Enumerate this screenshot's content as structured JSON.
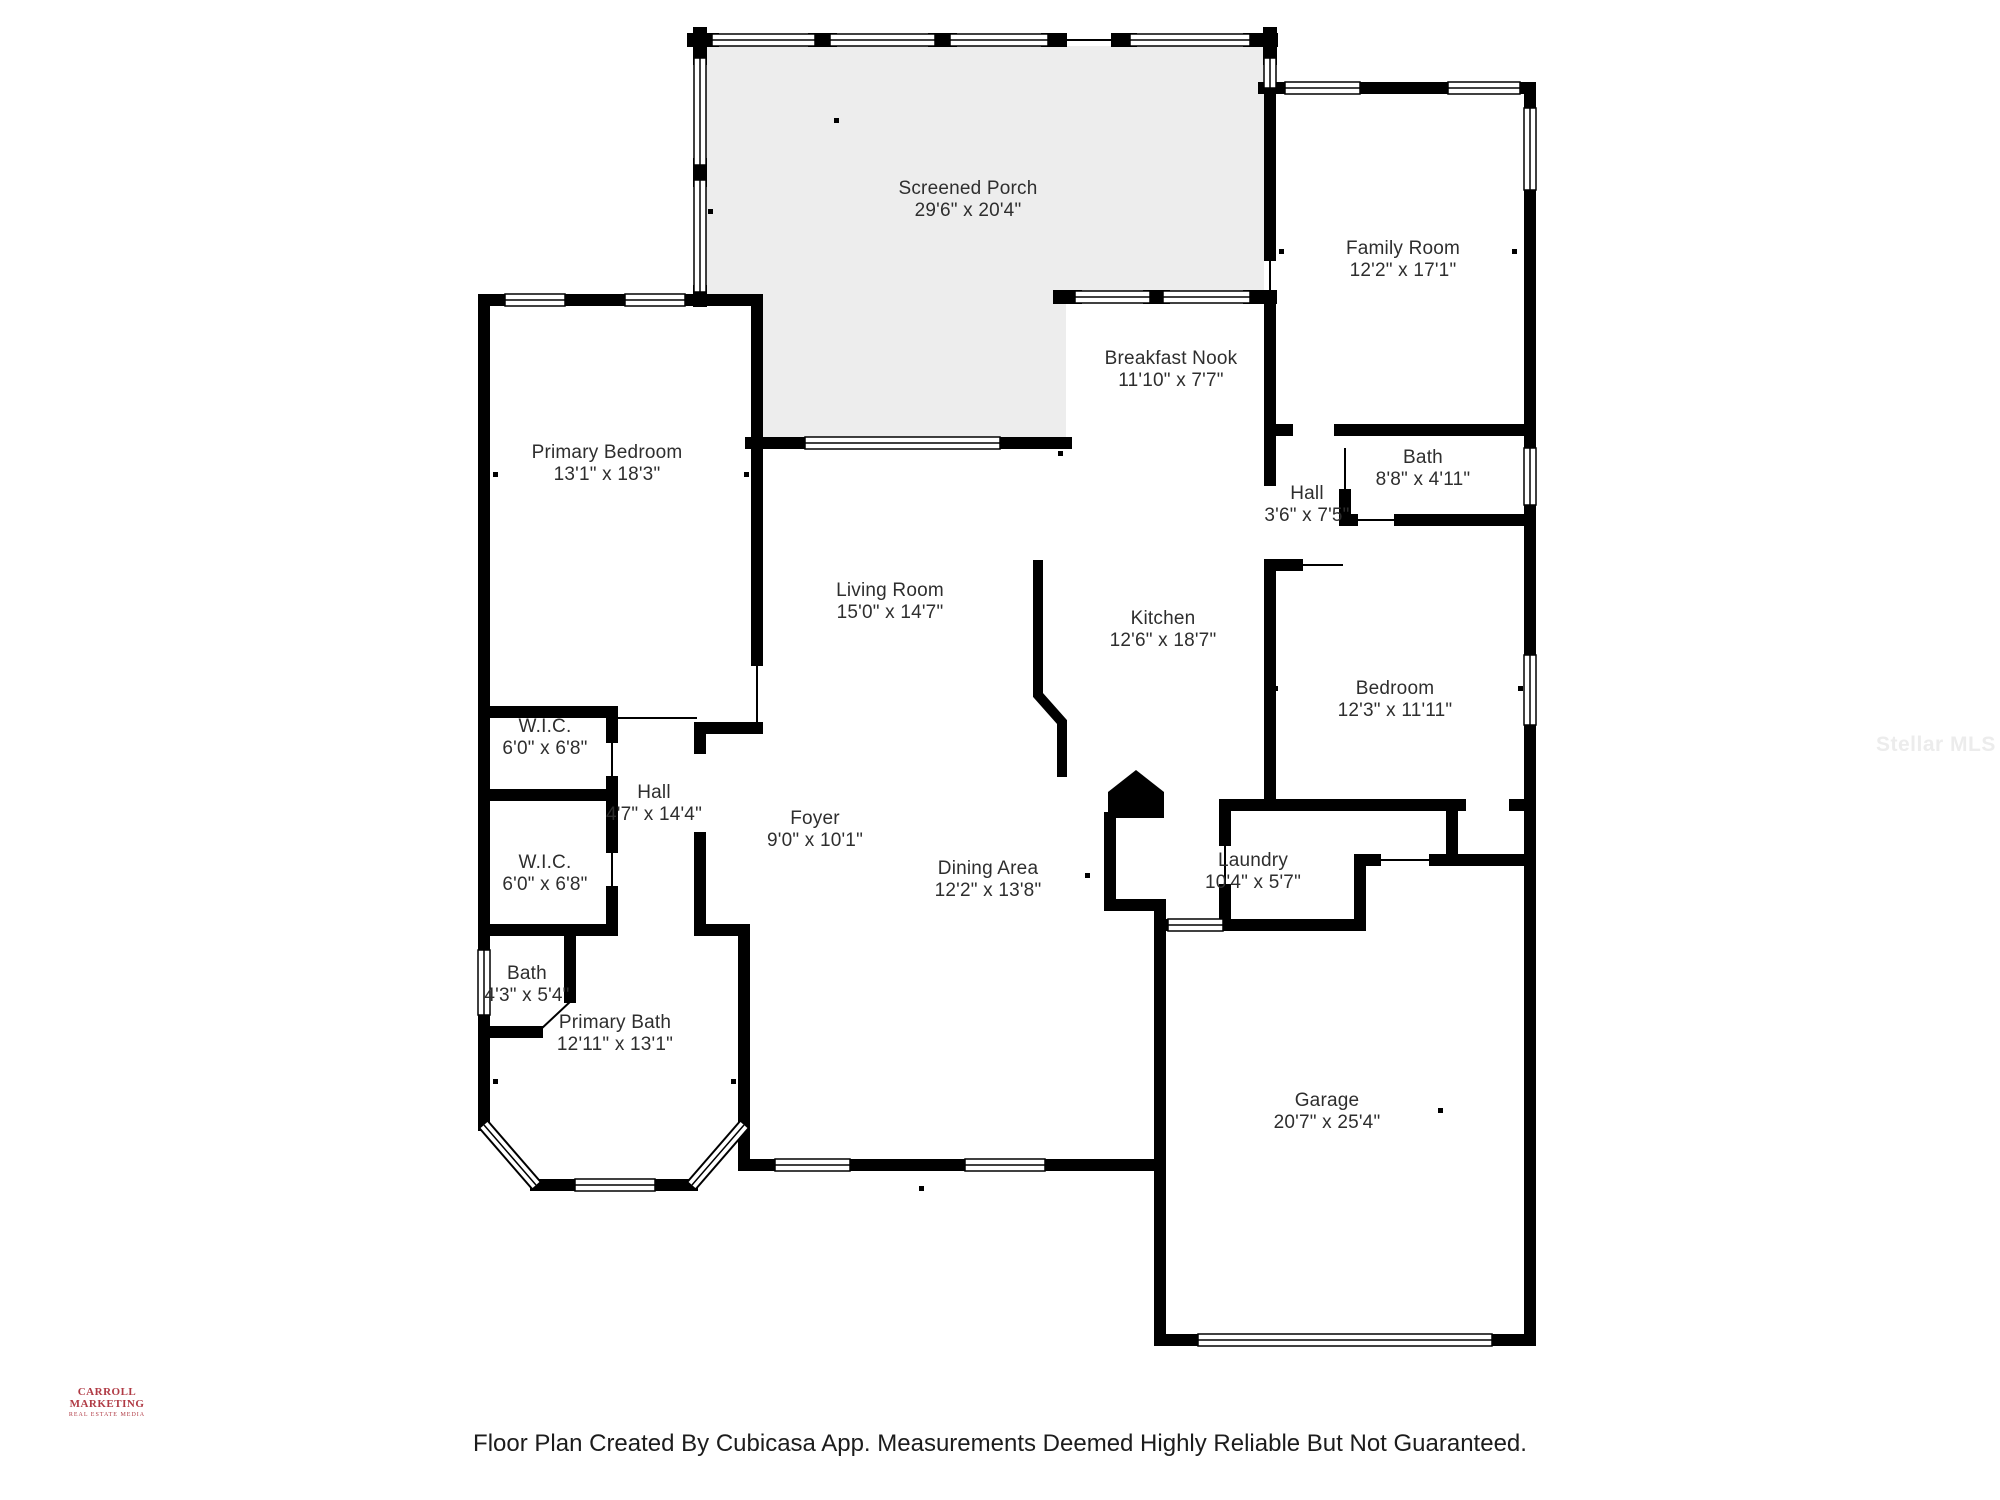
{
  "page": {
    "footer": "Floor Plan Created By Cubicasa App. Measurements Deemed Highly Reliable But Not Guaranteed.",
    "logo": {
      "line1": "CARROLL MARKETING",
      "line2": "REAL ESTATE MEDIA",
      "color": "#b03a44"
    },
    "watermark": "Stellar MLS",
    "background": "#ffffff"
  },
  "floorplan": {
    "wall_color": "#000000",
    "porch_fill": "#ededed",
    "rooms": [
      {
        "id": "screened-porch",
        "name": "Screened Porch",
        "dims": "29'6\" x 20'4\"",
        "x": 968,
        "y": 178
      },
      {
        "id": "family-room",
        "name": "Family Room",
        "dims": "12'2\" x 17'1\"",
        "x": 1403,
        "y": 238
      },
      {
        "id": "breakfast-nook",
        "name": "Breakfast Nook",
        "dims": "11'10\" x 7'7\"",
        "x": 1171,
        "y": 348
      },
      {
        "id": "bath-upper",
        "name": "Bath",
        "dims": "8'8\" x 4'11\"",
        "x": 1423,
        "y": 447
      },
      {
        "id": "hall-upper",
        "name": "Hall",
        "dims": "3'6\" x 7'5\"",
        "x": 1307,
        "y": 483
      },
      {
        "id": "primary-bedroom",
        "name": "Primary Bedroom",
        "dims": "13'1\" x 18'3\"",
        "x": 607,
        "y": 442
      },
      {
        "id": "living-room",
        "name": "Living Room",
        "dims": "15'0\" x 14'7\"",
        "x": 890,
        "y": 580
      },
      {
        "id": "kitchen",
        "name": "Kitchen",
        "dims": "12'6\" x 18'7\"",
        "x": 1163,
        "y": 608
      },
      {
        "id": "bedroom",
        "name": "Bedroom",
        "dims": "12'3\" x 11'11\"",
        "x": 1395,
        "y": 678
      },
      {
        "id": "wic-1",
        "name": "W.I.C.",
        "dims": "6'0\" x 6'8\"",
        "x": 545,
        "y": 716
      },
      {
        "id": "hall-left",
        "name": "Hall",
        "dims": "4'7\" x 14'4\"",
        "x": 654,
        "y": 782
      },
      {
        "id": "wic-2",
        "name": "W.I.C.",
        "dims": "6'0\" x 6'8\"",
        "x": 545,
        "y": 852
      },
      {
        "id": "foyer",
        "name": "Foyer",
        "dims": "9'0\" x 10'1\"",
        "x": 815,
        "y": 808
      },
      {
        "id": "dining-area",
        "name": "Dining Area",
        "dims": "12'2\" x 13'8\"",
        "x": 988,
        "y": 858
      },
      {
        "id": "laundry",
        "name": "Laundry",
        "dims": "10'4\" x 5'7\"",
        "x": 1253,
        "y": 850
      },
      {
        "id": "bath-lower",
        "name": "Bath",
        "dims": "4'3\" x 5'4\"",
        "x": 527,
        "y": 963
      },
      {
        "id": "primary-bath",
        "name": "Primary Bath",
        "dims": "12'11\" x 13'1\"",
        "x": 615,
        "y": 1012
      },
      {
        "id": "garage",
        "name": "Garage",
        "dims": "20'7\" x 25'4\"",
        "x": 1327,
        "y": 1090
      }
    ]
  }
}
